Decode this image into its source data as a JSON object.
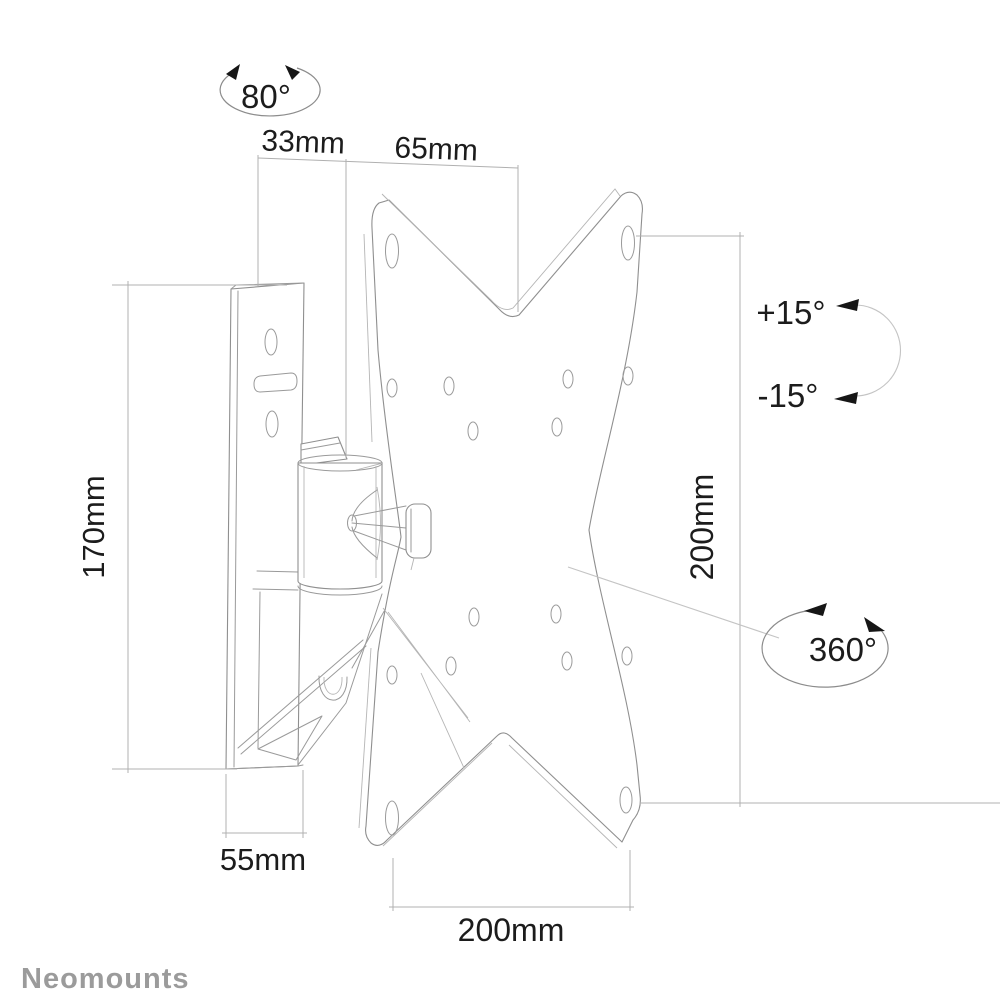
{
  "drawing": {
    "brand_logo": "Neomounts",
    "annotations": {
      "swivel_angle": "80°",
      "depth_wall_plate": "33mm",
      "depth_arm": "65mm",
      "wall_plate_height": "170mm",
      "wall_plate_width": "55mm",
      "vesa_width": "200mm",
      "vesa_height": "200mm",
      "tilt_up": "+15°",
      "tilt_down": "-15°",
      "rotation": "360°"
    },
    "colors": {
      "background": "#ffffff",
      "outline": "#8f8f8f",
      "dimension_line": "#b0b0b0",
      "text": "#1c1c1c",
      "logo": "#9b9b9b",
      "arrow": "#161616"
    }
  }
}
